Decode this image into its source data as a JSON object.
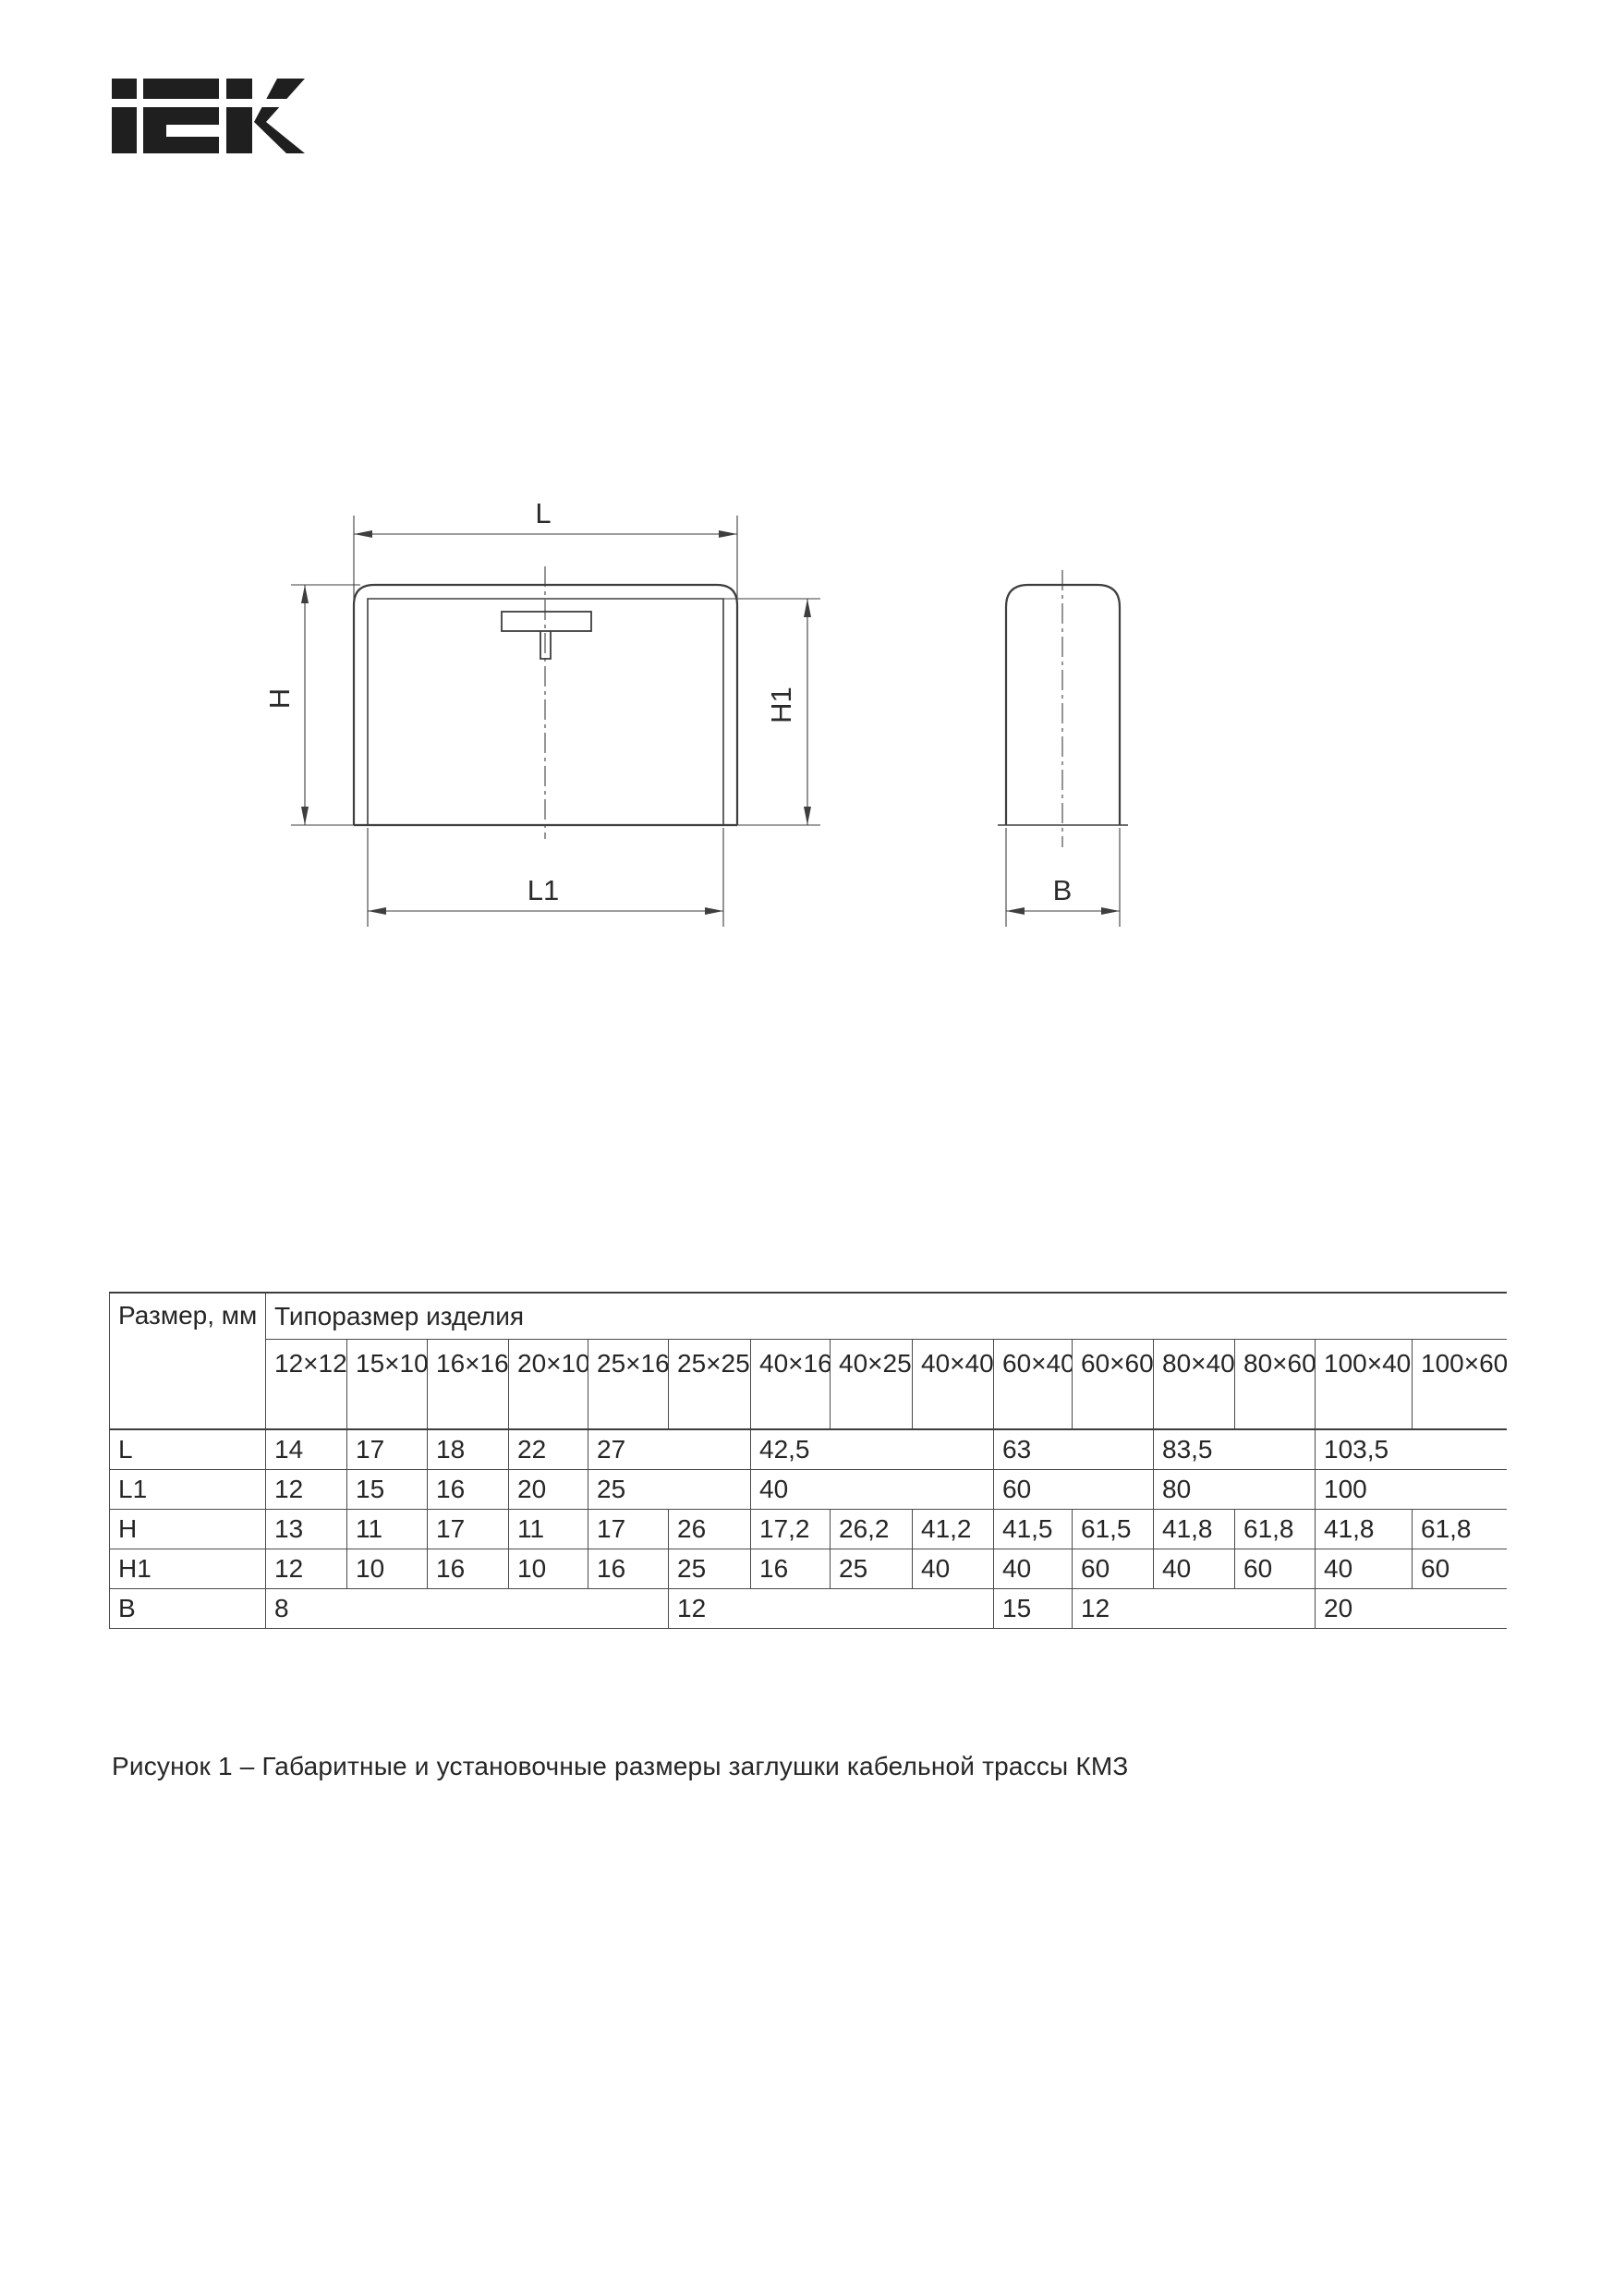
{
  "logo": {
    "text": "IEK",
    "color": "#1f1f1f"
  },
  "drawing": {
    "line_color": "#3e3e3e",
    "labels": {
      "l": "L",
      "l1": "L1",
      "h": "H",
      "h1": "H1",
      "b": "B"
    }
  },
  "table": {
    "corner_header": "Размер, мм",
    "group_header": "Типоразмер изделия",
    "size_headers": [
      "12×12",
      "15×10",
      "16×16",
      "20×10",
      "25×16",
      "25×25",
      "40×16",
      "40×25",
      "40×40",
      "60×40",
      "60×60",
      "80×40",
      "80×60",
      "100×40",
      "100×60"
    ],
    "rows": [
      {
        "label": "L",
        "cells": [
          {
            "v": "14",
            "span": 1
          },
          {
            "v": "17",
            "span": 1
          },
          {
            "v": "18",
            "span": 1
          },
          {
            "v": "22",
            "span": 1
          },
          {
            "v": "27",
            "span": 2
          },
          {
            "v": "42,5",
            "span": 3
          },
          {
            "v": "63",
            "span": 2
          },
          {
            "v": "83,5",
            "span": 2
          },
          {
            "v": "103,5",
            "span": 2
          }
        ]
      },
      {
        "label": "L1",
        "cells": [
          {
            "v": "12",
            "span": 1
          },
          {
            "v": "15",
            "span": 1
          },
          {
            "v": "16",
            "span": 1
          },
          {
            "v": "20",
            "span": 1
          },
          {
            "v": "25",
            "span": 2
          },
          {
            "v": "40",
            "span": 3
          },
          {
            "v": "60",
            "span": 2
          },
          {
            "v": "80",
            "span": 2
          },
          {
            "v": "100",
            "span": 2
          }
        ]
      },
      {
        "label": "H",
        "cells": [
          {
            "v": "13",
            "span": 1
          },
          {
            "v": "11",
            "span": 1
          },
          {
            "v": "17",
            "span": 1
          },
          {
            "v": "11",
            "span": 1
          },
          {
            "v": "17",
            "span": 1
          },
          {
            "v": "26",
            "span": 1
          },
          {
            "v": "17,2",
            "span": 1
          },
          {
            "v": "26,2",
            "span": 1
          },
          {
            "v": "41,2",
            "span": 1
          },
          {
            "v": "41,5",
            "span": 1
          },
          {
            "v": "61,5",
            "span": 1
          },
          {
            "v": "41,8",
            "span": 1
          },
          {
            "v": "61,8",
            "span": 1
          },
          {
            "v": "41,8",
            "span": 1
          },
          {
            "v": "61,8",
            "span": 1
          }
        ]
      },
      {
        "label": "H1",
        "cells": [
          {
            "v": "12",
            "span": 1
          },
          {
            "v": "10",
            "span": 1
          },
          {
            "v": "16",
            "span": 1
          },
          {
            "v": "10",
            "span": 1
          },
          {
            "v": "16",
            "span": 1
          },
          {
            "v": "25",
            "span": 1
          },
          {
            "v": "16",
            "span": 1
          },
          {
            "v": "25",
            "span": 1
          },
          {
            "v": "40",
            "span": 1
          },
          {
            "v": "40",
            "span": 1
          },
          {
            "v": "60",
            "span": 1
          },
          {
            "v": "40",
            "span": 1
          },
          {
            "v": "60",
            "span": 1
          },
          {
            "v": "40",
            "span": 1
          },
          {
            "v": "60",
            "span": 1
          }
        ]
      },
      {
        "label": "B",
        "cells": [
          {
            "v": "8",
            "span": 5
          },
          {
            "v": "12",
            "span": 4
          },
          {
            "v": "15",
            "span": 1
          },
          {
            "v": "12",
            "span": 3
          },
          {
            "v": "20",
            "span": 2
          }
        ]
      }
    ]
  },
  "caption": {
    "text": "Рисунок 1 – Габаритные и установочные размеры заглушки кабельной трассы КМЗ"
  }
}
